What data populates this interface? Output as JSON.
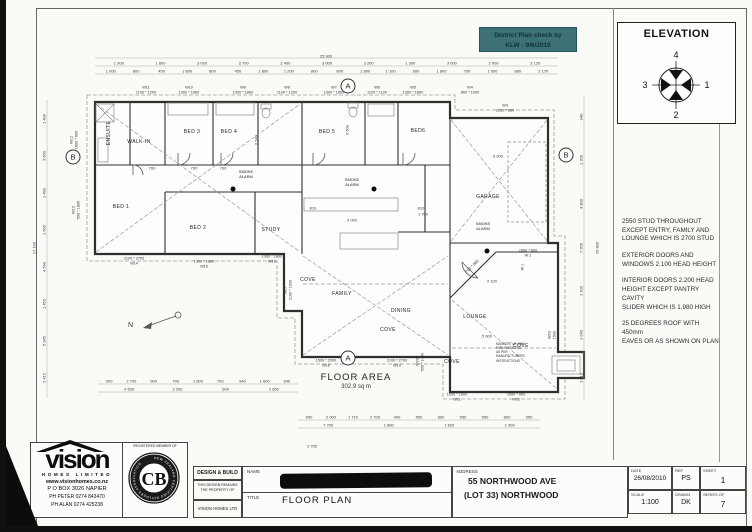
{
  "stamp": {
    "line1": "District Plan check by",
    "line2": "KLW - 9/6/2010"
  },
  "elevation": {
    "title": "ELEVATION",
    "top": "4",
    "right": "1",
    "bottom": "2",
    "left": "3"
  },
  "notes": [
    "2550 STUD THROUGHOUT\nEXCEPT ENTRY, FAMILY AND\nLOUNGE WHICH IS 2700 STUD",
    "EXTERIOR DOORS AND\nWINDOWS 2.100 HEAD HEIGHT",
    "INTERIOR DOORS 2.200 HEAD\nHEIGHT EXCEPT PANTRY CAVITY\nSLIDER WHICH IS 1.980 HIGH",
    "25 DEGREES ROOF WITH 450mm\nEAVES OR AS SHOWN ON PLAN"
  ],
  "plan": {
    "floor_area_label": "FLOOR AREA",
    "floor_area_value": "302.9 sq m",
    "north_label": "N",
    "smoke_alarm_label": "SMOKE\nALARM",
    "fire_note": "MASPORT LE 4000\nFIRE INSTALLED\nAS PER\nMANUFACTURERS\nINSTRUCTIONS",
    "rooms": [
      {
        "label": "ENSUITE",
        "x": 109,
        "y": 133,
        "rot": -90
      },
      {
        "label": "WALK-IN",
        "x": 139,
        "y": 142
      },
      {
        "label": "BED 1",
        "x": 121,
        "y": 207
      },
      {
        "label": "BED 2",
        "x": 198,
        "y": 228
      },
      {
        "label": "BED 3",
        "x": 192,
        "y": 132
      },
      {
        "label": "BED 4",
        "x": 229,
        "y": 132
      },
      {
        "label": "BED 5",
        "x": 327,
        "y": 132
      },
      {
        "label": "BED6",
        "x": 418,
        "y": 131
      },
      {
        "label": "STUDY",
        "x": 271,
        "y": 230
      },
      {
        "label": "FAMILY",
        "x": 342,
        "y": 294
      },
      {
        "label": "DINING",
        "x": 401,
        "y": 311
      },
      {
        "label": "LOUNGE",
        "x": 475,
        "y": 317
      },
      {
        "label": "GARAGE",
        "x": 488,
        "y": 197
      },
      {
        "label": "COVE",
        "x": 308,
        "y": 280
      },
      {
        "label": "COVE",
        "x": 388,
        "y": 330
      },
      {
        "label": "COVE",
        "x": 452,
        "y": 362
      },
      {
        "label": "COVE",
        "x": 521,
        "y": 346
      }
    ],
    "windows": [
      {
        "lines": [
          "W11",
          "1100 * 1200"
        ],
        "x": 146,
        "y": 90
      },
      {
        "lines": [
          "W10",
          "1300 * 1800"
        ],
        "x": 189,
        "y": 90
      },
      {
        "lines": [
          "W9",
          "1300 * 1800"
        ],
        "x": 243,
        "y": 90
      },
      {
        "lines": [
          "W8",
          "1100 * 1200"
        ],
        "x": 287,
        "y": 90
      },
      {
        "lines": [
          "W7",
          "1300 * 1800"
        ],
        "x": 334,
        "y": 90
      },
      {
        "lines": [
          "W6",
          "1100 * 1100"
        ],
        "x": 377,
        "y": 90
      },
      {
        "lines": [
          "W5",
          "1300 * 1800"
        ],
        "x": 413,
        "y": 90
      },
      {
        "lines": [
          "W4",
          "800 * 1000"
        ],
        "x": 470,
        "y": 90
      },
      {
        "lines": [
          "W3",
          "2100 * 860"
        ],
        "x": 505,
        "y": 108
      },
      {
        "lines": [
          "W12",
          "1800 * 600"
        ],
        "x": 74,
        "y": 140,
        "rot": -90
      },
      {
        "lines": [
          "W13",
          "500 * 1800"
        ],
        "x": 76,
        "y": 210,
        "rot": -90
      },
      {
        "lines": [
          "2100 * 2700",
          "W14"
        ],
        "x": 134,
        "y": 261
      },
      {
        "lines": [
          "1300 * 1800",
          "W15"
        ],
        "x": 204,
        "y": 264
      },
      {
        "lines": [
          "1300 * 1800",
          "W16"
        ],
        "x": 272,
        "y": 259
      },
      {
        "lines": [
          "W17",
          "2100 * 1000"
        ],
        "x": 288,
        "y": 290,
        "rot": -90
      },
      {
        "lines": [
          "1500 * 2000",
          "W18"
        ],
        "x": 326,
        "y": 363
      },
      {
        "lines": [
          "2100 * 2700",
          "W19"
        ],
        "x": 397,
        "y": 363
      },
      {
        "lines": [
          "W20",
          "500 * 1400"
        ],
        "x": 420,
        "y": 362,
        "rot": -90
      },
      {
        "lines": [
          "1500 * 1500",
          "W21"
        ],
        "x": 457,
        "y": 397
      },
      {
        "lines": [
          "1500 * 800",
          "W22"
        ],
        "x": 516,
        "y": 397
      },
      {
        "lines": [
          "W23",
          "1500"
        ],
        "x": 552,
        "y": 335,
        "rot": -90
      },
      {
        "lines": [
          "1500 * 600",
          "W 2"
        ],
        "x": 528,
        "y": 253
      },
      {
        "lines": [
          "W 1"
        ],
        "x": 523,
        "y": 267,
        "rot": -90
      }
    ],
    "misc_dims": [
      {
        "t": "25 900",
        "x": 326,
        "y": 56
      },
      {
        "t": "17 190",
        "x": 34,
        "y": 248,
        "rot": -90
      },
      {
        "t": "16 800",
        "x": 597,
        "y": 248,
        "rot": -90
      },
      {
        "t": "2 705",
        "x": 312,
        "y": 446
      },
      {
        "t": "5 900",
        "x": 498,
        "y": 156
      },
      {
        "t": "4 000",
        "x": 352,
        "y": 220
      },
      {
        "t": "2 100",
        "x": 492,
        "y": 281
      },
      {
        "t": "5 600",
        "x": 487,
        "y": 336
      },
      {
        "t": "760",
        "x": 152,
        "y": 168
      },
      {
        "t": "760",
        "x": 194,
        "y": 168
      },
      {
        "t": "760",
        "x": 223,
        "y": 168
      },
      {
        "t": "810",
        "x": 313,
        "y": 208
      },
      {
        "t": "810",
        "x": 421,
        "y": 208
      },
      {
        "t": "1 700",
        "x": 423,
        "y": 214
      },
      {
        "t": "2 540",
        "x": 256,
        "y": 140,
        "rot": -90
      },
      {
        "t": "3 600",
        "x": 347,
        "y": 130,
        "rot": -90
      },
      {
        "t": "760 * 960",
        "x": 472,
        "y": 266,
        "rot": -45
      }
    ],
    "section_markers": [
      {
        "t": "A",
        "x": 348,
        "y": 86
      },
      {
        "t": "A",
        "x": 348,
        "y": 358
      },
      {
        "t": "B",
        "x": 73,
        "y": 157
      },
      {
        "t": "B",
        "x": 566,
        "y": 155
      }
    ],
    "smoke_alarms": [
      {
        "x": 246,
        "y": 174,
        "dx": 233,
        "dy": 189
      },
      {
        "x": 352,
        "y": 182,
        "dx": 374,
        "dy": 189
      },
      {
        "x": 483,
        "y": 226,
        "dx": 487,
        "dy": 251
      }
    ],
    "chains": [
      {
        "dir": "h",
        "x1": 98,
        "x2": 556,
        "y": 63,
        "items": [
          "1 900",
          "1 800",
          "3 000",
          "2 700",
          "2 400",
          "3 000",
          "3 200",
          "1 300",
          "3 000",
          "2 000",
          "3 120"
        ]
      },
      {
        "dir": "h",
        "x1": 98,
        "x2": 556,
        "y": 71,
        "items": [
          "1 000",
          "800",
          "450",
          "1 800",
          "800",
          "450",
          "1 800",
          "1 200",
          "800",
          "800",
          "1 800",
          "1 100",
          "600",
          "1 800",
          "790",
          "1 000",
          "860",
          "2 170"
        ]
      },
      {
        "dir": "h",
        "x1": 98,
        "x2": 298,
        "y": 381,
        "items": [
          "900",
          "2 700",
          "900",
          "700",
          "1 800",
          "700",
          "540",
          "1 600",
          "540"
        ]
      },
      {
        "dir": "h",
        "x1": 105,
        "x2": 298,
        "y": 389,
        "items": [
          "4 500",
          "3 200",
          "600",
          "2 650"
        ]
      },
      {
        "dir": "h",
        "x1": 298,
        "x2": 540,
        "y": 417,
        "items": [
          "600",
          "2 000",
          "1 710",
          "2 700",
          "490",
          "550",
          "800",
          "550",
          "550",
          "800",
          "550"
        ]
      },
      {
        "dir": "h",
        "x1": 298,
        "x2": 540,
        "y": 425,
        "items": [
          "7 700",
          "1 800",
          "1 620",
          "1 900"
        ]
      },
      {
        "dir": "v",
        "x": 44,
        "y1": 100,
        "y2": 396,
        "items": [
          "1 400",
          "3 600",
          "1 490",
          "1 600",
          "4 590",
          "1 450",
          "5 345",
          "2 415"
        ]
      },
      {
        "dir": "v",
        "x": 581,
        "y1": 95,
        "y2": 400,
        "items": [
          "940",
          "1 200",
          "4 800",
          "7 205",
          "1 200",
          "1 640",
          "1 810"
        ]
      }
    ]
  },
  "title_block": {
    "vision": {
      "name": "vision",
      "subtitle": "HOMES LIMITED",
      "website": "www.visionhomes.co.nz",
      "po_box": "P O BOX 3026 NAPIER",
      "phone1": "PH PETER 0274 843470",
      "phone2": "PH ALAN 0274 425238"
    },
    "member": {
      "label": "REGISTERED MEMBER OF",
      "logo": "CB",
      "ring_text": "NEW ZEALAND CERTIFIED BUILDERS ASSOCIATION"
    },
    "design_build": {
      "line1": "DESIGN & BUILD",
      "line2": "THIS DESIGN REMAINS THE PROPERTY OF",
      "line3": "VISION HOMES LTD"
    },
    "name_label": "NAME",
    "title_label": "TITLE",
    "title_value": "FLOOR PLAN",
    "address_label": "ADDRESS",
    "address_line1": "55 NORTHWOOD AVE",
    "address_line2": "(LOT 33) NORTHWOOD",
    "date_label": "DATE",
    "date_value": "26/08/2010",
    "ref_label": "REF",
    "ref_value": "PS",
    "sheet_label": "SHEET",
    "sheet_value": "1",
    "scale_label": "SCALE",
    "scale_value": "1:100",
    "drawn_label": "DRAWN",
    "drawn_value": "DK",
    "series_label": "SERIES OF",
    "series_value": "7"
  }
}
